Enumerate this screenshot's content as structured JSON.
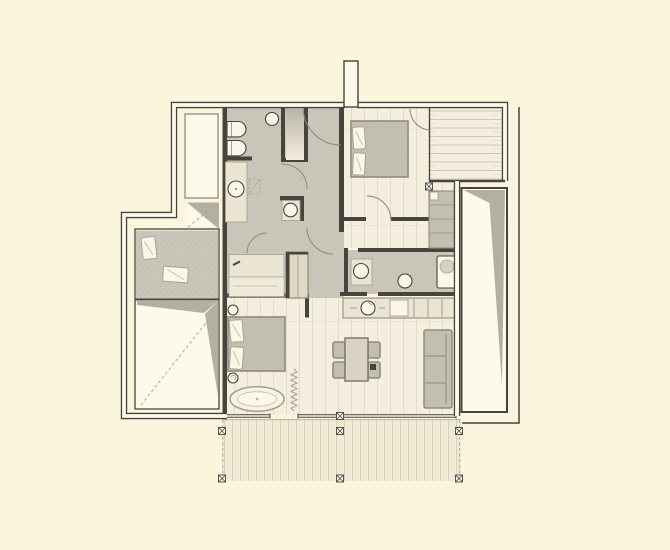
{
  "meta": {
    "title": "Apartment floor plan drawing",
    "drawing_type": "architectural top-view plan, no text labels visible"
  },
  "colors": {
    "bg": "#FBF5DE",
    "wallDark": "#47443D",
    "wallFill": "#FDFAEC",
    "floorGray": "#C9C5B9",
    "floorWood": "#F3EEDD",
    "floorWoodLine": "#E0D9C3",
    "deckWood": "#F0EAD5",
    "deckLine": "#D8D1B8",
    "counter": "#EAE5D3",
    "fixtureWhite": "#FAF6E8",
    "furnGray": "#C2BEB0",
    "furnBorder": "#8F8B7E",
    "wardrobe": "#DED8C4",
    "wedgeGray": "#B3AFA1",
    "dashLine": "#ACA697",
    "arcLine": "#8D887B",
    "balconyLine": "#DCD5C0"
  },
  "elements": {
    "rooms": [
      "bathroom-top-left",
      "shower-cell",
      "central-hall",
      "bedroom-top-right",
      "bathroom-middle-right",
      "kitchen-counter",
      "living-dining-area",
      "bedroom-bottom-left",
      "dressing-area",
      "side-room-left-wing",
      "sloped-void-left",
      "sloped-void-right",
      "balcony-top-right",
      "wood-deck-bottom"
    ],
    "furniture_icons": [
      "toilet-icon",
      "bidet-icon",
      "washbasin-icon",
      "round-basin-icon",
      "double-bed-icon",
      "pillow-icon",
      "bathtub-built-in-icon",
      "freestanding-oval-bathtub-icon",
      "dining-table-icon",
      "chair-icon",
      "sofa-icon",
      "wardrobe-icon",
      "desk-icon",
      "kitchen-sink-icon",
      "cooktop-icon",
      "stool-icon",
      "curtain-zigzag-icon"
    ],
    "symbols": [
      "door-swing-arc",
      "column-marker-x",
      "dashed-slope-line",
      "window-glazing-double-line",
      "chimney-duct"
    ]
  }
}
